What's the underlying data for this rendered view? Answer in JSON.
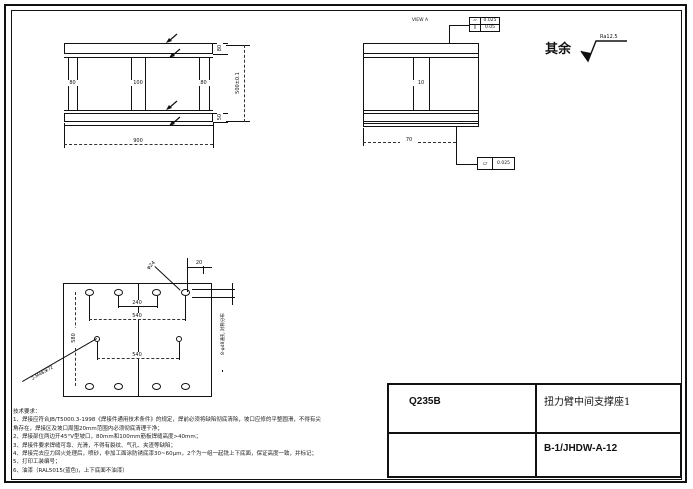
{
  "title_block": {
    "material": "Q235B",
    "part_name": "扭力臂中间支撑座1",
    "drawing_no": "B-1/JHDW-A-12"
  },
  "surface_note": {
    "prefix": "其余",
    "roughness": "Ra12.5"
  },
  "front_view": {
    "rib_left": "80",
    "rib_mid": "100",
    "rib_right": "80",
    "flange_top": "80",
    "flange_bottom": "50",
    "height": "500±0.1",
    "width": "900"
  },
  "view_a": {
    "label": "VIEW A",
    "rib": "10",
    "width": "70",
    "fcf_top_row1_sym": "▱",
    "fcf_top_row1_val": "0.025",
    "fcf_top_row2_sym": "∥",
    "fcf_top_row2_val": "0.05",
    "fcf_bottom_sym": "▱",
    "fcf_bottom_val": "0.025"
  },
  "bottom_view": {
    "dim_pitch_inner": "240",
    "dim_pitch_top": "540",
    "dim_height": "580",
    "dim_pitch_mid": "540",
    "dim_edge": "20",
    "leader_hole": "φ24",
    "leader_thread": "2-M48深72",
    "note_holes": "8-φ48通孔 对称分布"
  },
  "tech": {
    "title": "技术要求：",
    "lines": [
      "1、焊接应符合JB/T5000.3-1998《焊接件通用技术条件》的规定，焊前必须将缺陷彻底清除，坡口应修的平整圆滑，不得有尖",
      "角存在，焊接区及坡口周围20mm范围内必须彻底清理干净；",
      "2、焊接部位两边开45°V型坡口，80mm和100mm筋板焊缝高度>40mm；",
      "3、焊接件要求焊缝可靠、光滑，不得有裂纹、气孔、夹渣等缺陷；",
      "4、焊接完去应力回火处理后，喷砂，非加工面涂防锈底漆30~60μm，2个为一组一起铣上下底面，保证高度一致，并标记；",
      "5、打印工装编号；",
      "6、油漆（RAL5015(蓝色)，上下底面不油漆）"
    ]
  }
}
